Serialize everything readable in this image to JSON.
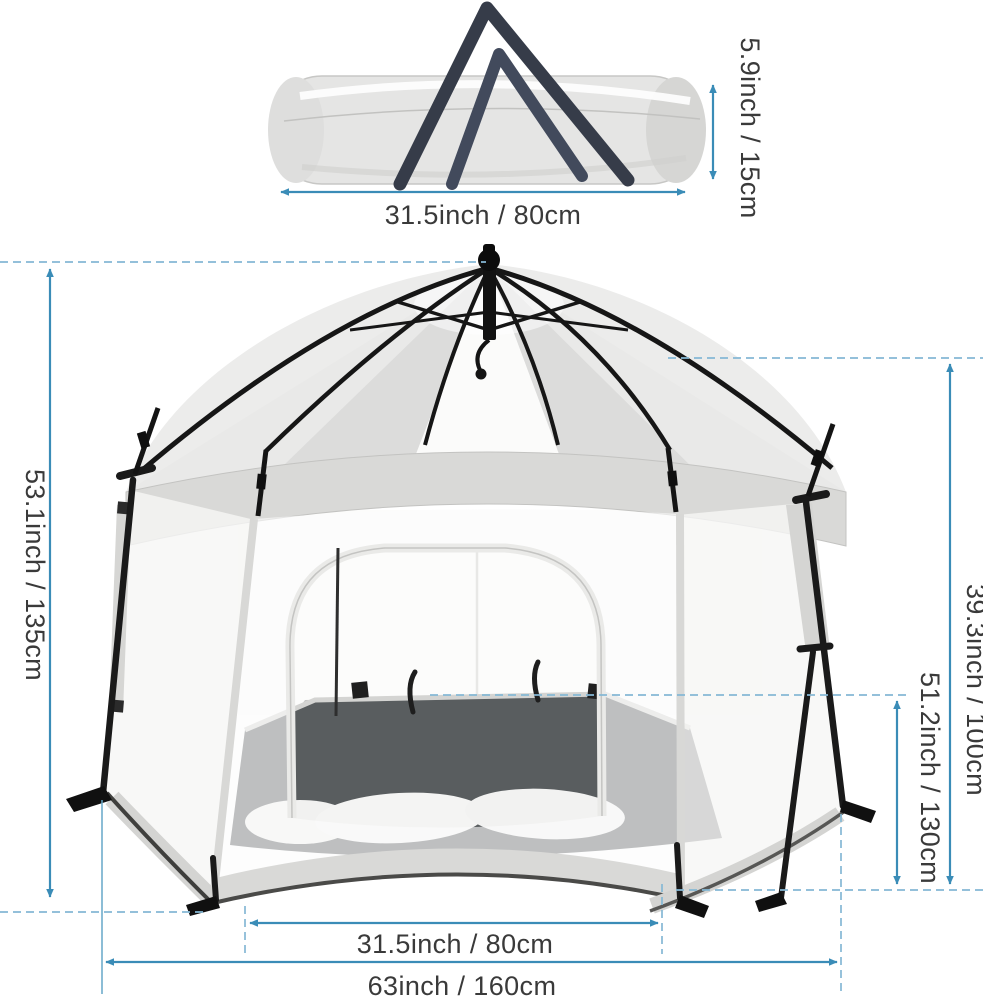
{
  "meta": {
    "background_color": "#ffffff",
    "accent_blue": "#3a8cb7",
    "dash_blue": "#85b8d5",
    "label_color": "#3a3a3a",
    "description": "Product dimension diagram of a hexagonal pop-up playpen tent and its rolled carry bag"
  },
  "bag": {
    "illustration": "rolled-carry-bag",
    "width_label": "31.5inch / 80cm",
    "height_label": "5.9inch / 15cm"
  },
  "tent": {
    "illustration": "hexagonal-pop-up-playpen-tent",
    "total_height_label": "53.1inch / 135cm",
    "wall_height_label": "39.3inch / 100cm",
    "inner_height_label": "51.2inch / 130cm",
    "door_width_label": "31.5inch / 80cm",
    "total_width_label": "63inch / 160cm"
  }
}
